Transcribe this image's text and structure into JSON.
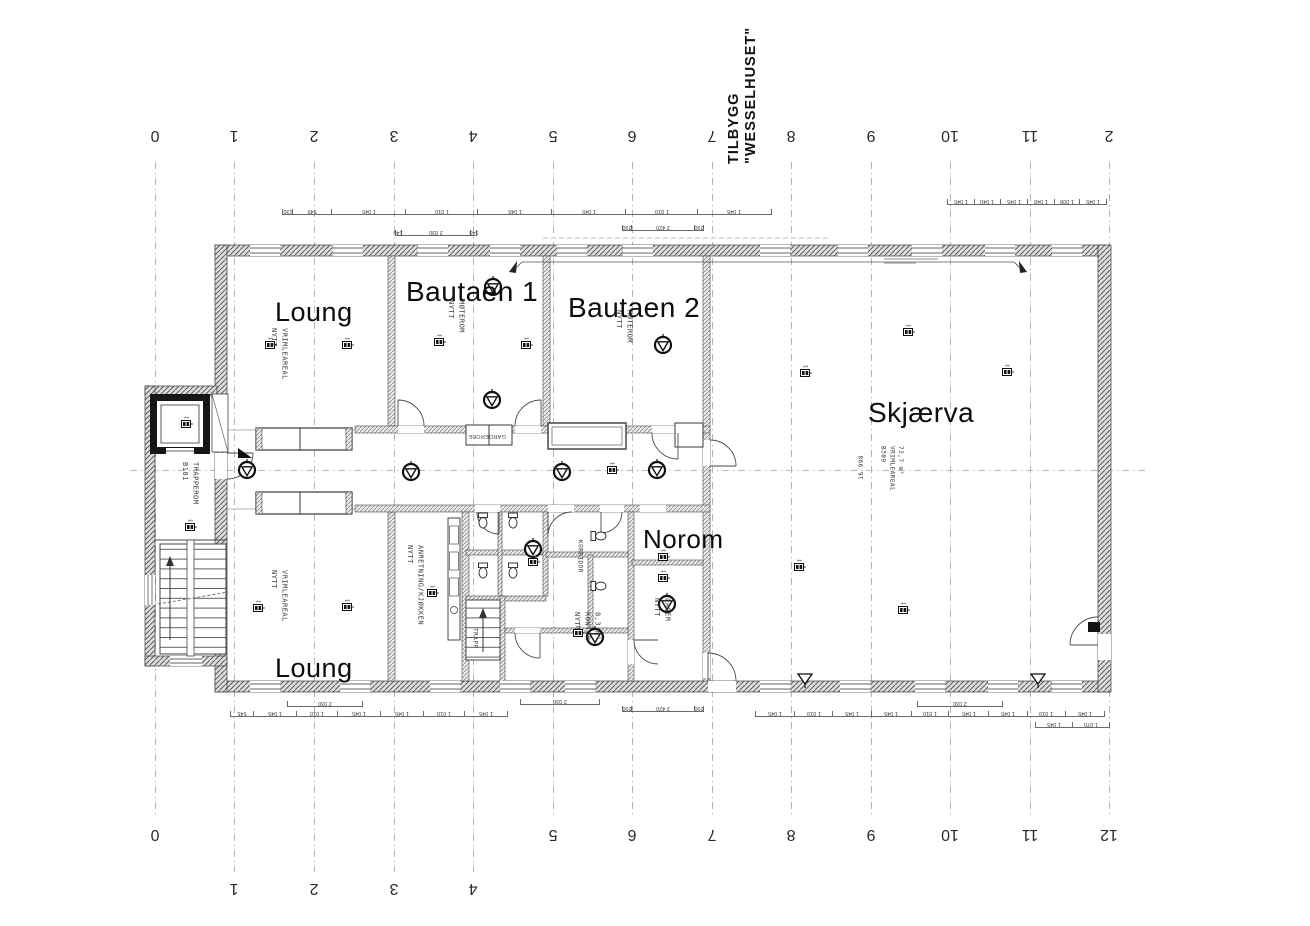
{
  "document": {
    "type": "Scanned architectural floor plan",
    "paper_color": "#ffffff",
    "ink_color": "#1a1a1a"
  },
  "title": {
    "line1": "TILBYGG",
    "line2": "\"WESSELHUSET\""
  },
  "grid": {
    "top_labels": [
      "0",
      "1",
      "2",
      "3",
      "4",
      "5",
      "6",
      "7",
      "8",
      "9",
      "10",
      "11",
      "2"
    ],
    "bottom_labels": [
      "0",
      "1",
      "2",
      "3",
      "4",
      "5",
      "6",
      "7",
      "8",
      "9",
      "10",
      "11",
      "12"
    ]
  },
  "rooms": {
    "loung_top": "Loung",
    "bautaen_1": "Bautaen 1",
    "bautaen_2": "Bautaen 2",
    "skjaerva": "Skjærva",
    "norom": "Norom",
    "loung_bottom": "Loung"
  },
  "annotations": {
    "vrimle_top": "NYTT\nVRIMLEAREAL",
    "moterom_1": "NYTT\nMØTEROM",
    "moterom_2": "NYTT\nMØTEROM",
    "vrimle_bottom": "NYTT\nVRIMLEAREAL",
    "kjokken": "NYTT\nANRETNING/KJØKKEN",
    "lager": "NYTT\nLAGER",
    "kontor": "NYTT\nKONTOR\n8,3 m²",
    "trapperom": "B101\nTRAPPEROM",
    "trapp": "TRAPP",
    "korridor": "KORRIDOR",
    "garderobe": "GARDEROBE",
    "vrimle_skjaerva": "B309\nVRIMLEAREAL\n73,7 m²",
    "dim_16998": "16 998"
  },
  "dimension_chains": {
    "top_left": [
      "130",
      "545",
      "1 045",
      "1 010",
      "1 045",
      "1 045",
      "1 010",
      "1 045"
    ],
    "top_left_opening": [
      "140",
      "2 030",
      "140"
    ],
    "top_mid_opening": [
      "290",
      "2 420",
      "290"
    ],
    "top_right": [
      "1 045",
      "1 040",
      "1 045",
      "1 048",
      "1 008",
      "1 045"
    ],
    "bottom_left": [
      "545",
      "1 045",
      "1 010",
      "1 045",
      "1 045",
      "1 010",
      "1 045"
    ],
    "bottom_left_opening": [
      "2 030"
    ],
    "bottom_mid2_opening": [
      "2 030"
    ],
    "bottom_mid_opening": [
      "290",
      "2 420",
      "290"
    ],
    "bottom_right": [
      "1 045",
      "1 010",
      "1 045",
      "1 045",
      "1 010",
      "1 045",
      "1 045",
      "1 010",
      "1 045"
    ],
    "bottom_right_opening": [
      "2 030"
    ],
    "bottom_far_right": [
      "1 045",
      "1 070"
    ]
  },
  "icons": {
    "ventilation-valve-icon": "circle with inscribed triangle (ceiling valve)",
    "electrical-point-icon": "small box with twin dark poles",
    "floor-drain-icon": "open triangle with stem",
    "wc-icon": "toilet fixture (tank + bowl)",
    "window-icon": "double-line opening in wall"
  }
}
